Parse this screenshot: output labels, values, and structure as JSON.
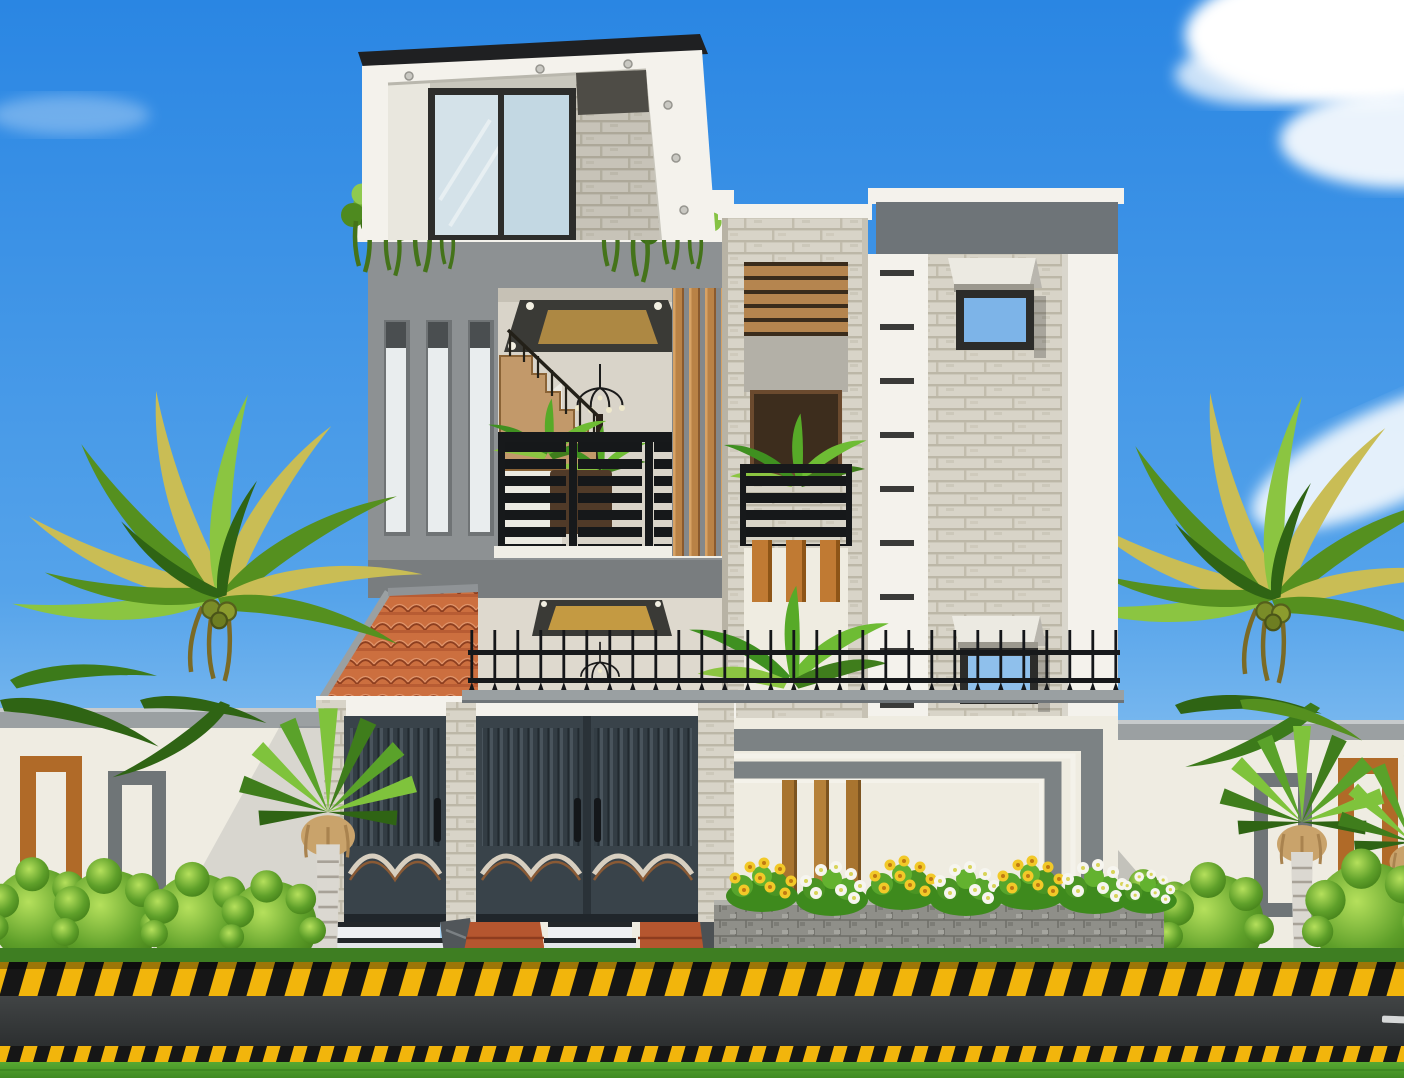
{
  "scene": {
    "title": "Modern two-tower duplex house - front elevation 3D render",
    "setting": "daytime street view with palm trees, compound wall, flower bed and road"
  },
  "palette": {
    "sky_top": "#2a86e3",
    "sky_mid": "#55a3ea",
    "sky_horizon": "#badef7",
    "cloud": "#ffffff",
    "facade_gray": "#8d9193",
    "slab_gray": "#797d7f",
    "white_trim": "#f4f2ec",
    "facade_cream": "#efece1",
    "interior_cream": "#ded9ce",
    "parapet_dark": "#6e7478",
    "roof_slab_dark": "#1f2022",
    "brick_light": "#d8d4c8",
    "brick_mortar": "#bcb7a7",
    "wood_tan": "#b98246",
    "wood_orange": "#c07a33",
    "wood_dark": "#3a2c1c",
    "roof_tile": "#cc6f3f",
    "roof_tile_line": "#8d3e1f",
    "gate_dark": "#39434a",
    "gate_slat": "#333d44",
    "railing_black": "#17191b",
    "glass_blue": "#7db4e8",
    "glass_pale": "#d4e2e9",
    "leaf_bright": "#8bc541",
    "leaf_dark": "#55901f",
    "leaf_deep": "#2f6414",
    "palm_gold": "#c9bd55",
    "flower_yellow": "#f2c928",
    "flower_white": "#f6f5ef",
    "planter_stone": "#8f8f89",
    "coping_gray": "#9ba0a2",
    "marble_white": "#eef0f2",
    "step_stone": "#4c5154",
    "terracotta_paving": "#b5562f",
    "orange_frame": "#b06a28",
    "gray_frame": "#6f7577",
    "trunk_pale": "#dbd8d1",
    "skirt_tan": "#c9a36b",
    "road_asphalt": "#36393a",
    "curb_yellow": "#f2b50c",
    "curb_black": "#161616",
    "grass_green": "#4a9629",
    "lawn_dark": "#3e7e22"
  },
  "objects": {
    "house": {
      "floors_visible": 3,
      "left_tower_slit_windows": 3,
      "terrace_balusters": 5,
      "right_tower_windows": 2,
      "gate_leaves": 3,
      "balconies": 3
    },
    "landscaping": {
      "tall_palms": 2,
      "fan_palms": 3,
      "round_shrubs": 7,
      "flower_clusters": 7,
      "flower_colors": [
        "yellow",
        "white"
      ]
    },
    "street": {
      "curb_pattern": "yellow-black hazard stripes",
      "road_marking": "white dash",
      "foreground": "lawn"
    }
  }
}
